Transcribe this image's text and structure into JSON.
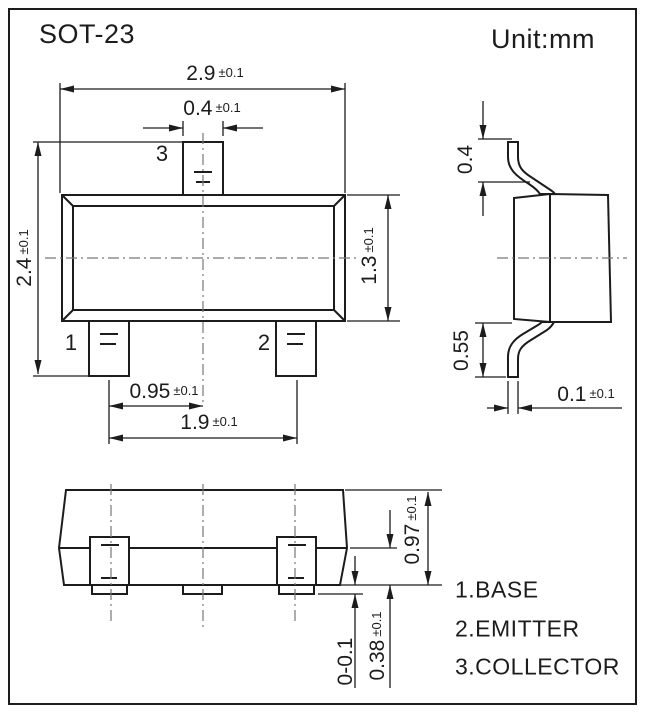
{
  "title": "SOT-23",
  "unit_label": "Unit:mm",
  "colors": {
    "line": "#1c1c1c",
    "background": "#ffffff",
    "centerline": "#777777"
  },
  "views": {
    "top": {
      "pins": [
        {
          "number": "1"
        },
        {
          "number": "2"
        },
        {
          "number": "3"
        }
      ],
      "dimensions": [
        {
          "id": "body-width",
          "value": "2.9",
          "tolerance": "±0.1"
        },
        {
          "id": "pin-width",
          "value": "0.4",
          "tolerance": "±0.1"
        },
        {
          "id": "overall-height",
          "value": "2.4",
          "tolerance": "±0.1"
        },
        {
          "id": "body-height",
          "value": "1.3",
          "tolerance": "±0.1"
        },
        {
          "id": "pin-pitch",
          "value": "0.95",
          "tolerance": "±0.1"
        },
        {
          "id": "pin-span",
          "value": "1.9",
          "tolerance": "±0.1"
        }
      ]
    },
    "side": {
      "dimensions": [
        {
          "id": "lead-top-length",
          "value": "0.4",
          "tolerance": ""
        },
        {
          "id": "lead-bottom-length",
          "value": "0.55",
          "tolerance": ""
        },
        {
          "id": "lead-thickness",
          "value": "0.1",
          "tolerance": "±0.1"
        }
      ]
    },
    "front": {
      "dimensions": [
        {
          "id": "body-total-height",
          "value": "0.97",
          "tolerance": "±0.1"
        },
        {
          "id": "lead-height",
          "value": "0.38",
          "tolerance": "±0.1"
        },
        {
          "id": "standoff",
          "value": "0-0.1",
          "tolerance": ""
        }
      ]
    }
  },
  "legend": [
    {
      "label": "1.BASE"
    },
    {
      "label": "2.EMITTER"
    },
    {
      "label": "3.COLLECTOR"
    }
  ]
}
